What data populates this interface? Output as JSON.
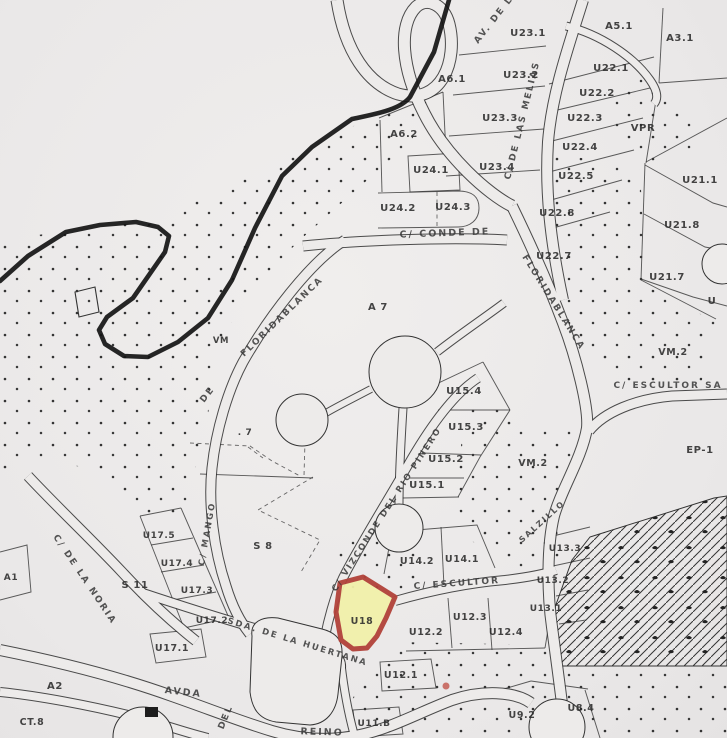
{
  "map": {
    "type": "scanned cadastral parcel plan",
    "background_color": "#edebea",
    "line_color": "#2e2e2e",
    "highlight_parcel": {
      "label": "U18",
      "fill": "#f2f1aa",
      "stroke": "#b2423a",
      "path": "M340,583 L363,577 L395,597 L386,618 L377,636 L367,648 L353,649 L341,640 L336,612 Z",
      "label_x": 362,
      "label_y": 624
    },
    "parcel_labels": [
      {
        "t": "U23.1",
        "x": 528,
        "y": 36
      },
      {
        "t": "A5.1",
        "x": 619,
        "y": 29
      },
      {
        "t": "A3.1",
        "x": 680,
        "y": 41
      },
      {
        "t": "A6.1",
        "x": 452,
        "y": 82
      },
      {
        "t": "U22.1",
        "x": 611,
        "y": 71
      },
      {
        "t": "U23.2",
        "x": 521,
        "y": 78
      },
      {
        "t": "U22.2",
        "x": 597,
        "y": 96
      },
      {
        "t": "U23.3",
        "x": 500,
        "y": 121
      },
      {
        "t": "U22.3",
        "x": 585,
        "y": 121
      },
      {
        "t": "VPR",
        "x": 643,
        "y": 131
      },
      {
        "t": "A6.2",
        "x": 404,
        "y": 137
      },
      {
        "t": "U22.4",
        "x": 580,
        "y": 150
      },
      {
        "t": "U24.1",
        "x": 431,
        "y": 173
      },
      {
        "t": "U23.4",
        "x": 497,
        "y": 170
      },
      {
        "t": "U22.5",
        "x": 576,
        "y": 179
      },
      {
        "t": "U21.1",
        "x": 700,
        "y": 183
      },
      {
        "t": "U24.2",
        "x": 398,
        "y": 211
      },
      {
        "t": "U24.3",
        "x": 453,
        "y": 210
      },
      {
        "t": "U22.8",
        "x": 557,
        "y": 216
      },
      {
        "t": "U21.8",
        "x": 682,
        "y": 228
      },
      {
        "t": "U22.7",
        "x": 554,
        "y": 259
      },
      {
        "t": "U21.7",
        "x": 667,
        "y": 280
      },
      {
        "t": "A 7",
        "x": 378,
        "y": 310
      },
      {
        "t": "U",
        "x": 712,
        "y": 304
      },
      {
        "t": "VM",
        "x": 221,
        "y": 343,
        "s": 8.5
      },
      {
        "t": "VM.2",
        "x": 673,
        "y": 355,
        "s": 9.5
      },
      {
        "t": "U15.4",
        "x": 464,
        "y": 394
      },
      {
        "t": ". 7",
        "x": 245,
        "y": 435,
        "s": 9
      },
      {
        "t": "U15.3",
        "x": 466,
        "y": 430
      },
      {
        "t": "EP-1",
        "x": 700,
        "y": 453
      },
      {
        "t": "U15.2",
        "x": 446,
        "y": 462
      },
      {
        "t": "VM.2",
        "x": 533,
        "y": 466,
        "s": 9.5
      },
      {
        "t": "U15.1",
        "x": 427,
        "y": 488
      },
      {
        "t": "U17.5",
        "x": 159,
        "y": 538,
        "s": 9
      },
      {
        "t": "U13.3",
        "x": 565,
        "y": 551,
        "s": 9
      },
      {
        "t": "S 8",
        "x": 263,
        "y": 549
      },
      {
        "t": "U14.2",
        "x": 417,
        "y": 564,
        "s": 9.5
      },
      {
        "t": "U14.1",
        "x": 462,
        "y": 562,
        "s": 9.5
      },
      {
        "t": "A1",
        "x": 11,
        "y": 580,
        "s": 9
      },
      {
        "t": "S 11",
        "x": 135,
        "y": 588
      },
      {
        "t": "U17.4",
        "x": 177,
        "y": 566,
        "s": 9
      },
      {
        "t": "U13.2",
        "x": 553,
        "y": 583,
        "s": 9
      },
      {
        "t": "U17.3",
        "x": 197,
        "y": 593,
        "s": 9
      },
      {
        "t": "U13.1",
        "x": 546,
        "y": 611,
        "s": 9
      },
      {
        "t": "U12.3",
        "x": 470,
        "y": 620,
        "s": 9.5
      },
      {
        "t": "U12.4",
        "x": 506,
        "y": 635,
        "s": 9.5
      },
      {
        "t": "U12.2",
        "x": 426,
        "y": 635,
        "s": 9.5
      },
      {
        "t": "U17.2",
        "x": 212,
        "y": 623,
        "s": 9
      },
      {
        "t": "U17.1",
        "x": 172,
        "y": 651,
        "s": 9.5
      },
      {
        "t": "A2",
        "x": 55,
        "y": 689
      },
      {
        "t": "U12.1",
        "x": 401,
        "y": 678,
        "s": 9.5
      },
      {
        "t": "CT.8",
        "x": 32,
        "y": 725,
        "s": 9.5
      },
      {
        "t": "U11.B",
        "x": 374,
        "y": 726,
        "s": 9
      },
      {
        "t": "U9.2",
        "x": 522,
        "y": 718,
        "s": 9.5
      },
      {
        "t": "U8.4",
        "x": 581,
        "y": 711,
        "s": 9.5
      }
    ],
    "street_labels": [
      {
        "t": "AV. DE LAS",
        "x": 478,
        "y": 44,
        "r": -52,
        "s": 9
      },
      {
        "t": "C/ DE LAS MELIAS",
        "x": 510,
        "y": 180,
        "r": -76,
        "s": 9
      },
      {
        "t": "C/ CONDE DE",
        "x": 445,
        "y": 236,
        "r": -2,
        "s": 9.5,
        "a": "middle"
      },
      {
        "t": "FLORIDABLANCA",
        "x": 522,
        "y": 257,
        "r": 58,
        "s": 9
      },
      {
        "t": "FLORIDABLANCA",
        "x": 244,
        "y": 357,
        "r": -44,
        "s": 9
      },
      {
        "t": "DE",
        "x": 204,
        "y": 403,
        "r": -52,
        "s": 9
      },
      {
        "t": "C/ VIZCONDE DEL RIO PINERO",
        "x": 336,
        "y": 592,
        "r": -57,
        "s": 8.5
      },
      {
        "t": "C/ MANGO",
        "x": 204,
        "y": 566,
        "r": -80,
        "s": 8.5
      },
      {
        "t": "C/ DE LA NORIA",
        "x": 53,
        "y": 537,
        "r": 56,
        "s": 9
      },
      {
        "t": "SDA. DE LA HUERTANA",
        "x": 227,
        "y": 623,
        "r": 17,
        "s": 8.5
      },
      {
        "t": "C/ ESCULTOR",
        "x": 457,
        "y": 586,
        "r": -4,
        "s": 9,
        "a": "middle"
      },
      {
        "t": "C/ ESCULTOR SA",
        "x": 668,
        "y": 388,
        "r": 0,
        "s": 9,
        "a": "middle"
      },
      {
        "t": "SALZILLO",
        "x": 522,
        "y": 543,
        "r": -42,
        "s": 8
      },
      {
        "t": "AVDA",
        "x": 183,
        "y": 695,
        "r": 6,
        "s": 9.5,
        "a": "middle"
      },
      {
        "t": "DEL",
        "x": 228,
        "y": 718,
        "r": -68,
        "s": 9,
        "a": "middle"
      },
      {
        "t": "REINO",
        "x": 322,
        "y": 735,
        "r": 2,
        "s": 9.5,
        "a": "middle"
      }
    ],
    "roads": [
      {
        "n": "av-melias-loop",
        "d": "M337,0 C345,52 368,84 398,94 C442,106 458,60 449,24 C444,4 427,-3 416,7 C398,25 401,68 424,113 C446,157 488,194 512,206",
        "w": 11
      },
      {
        "n": "floridablanca-north",
        "d": "M583,0 C570,42 552,92 548,142 C545,190 550,240 563,300",
        "w": 10
      },
      {
        "n": "floridablanca",
        "d": "M512,206 C530,243 548,283 563,323 C576,357 589,408 587,428 C582,458 561,490 554,516 C547,545 547,592 552,627 C556,658 562,700 566,738",
        "w": 10
      },
      {
        "n": "road-topright",
        "d": "M566,26 C600,34 634,57 650,80 C657,90 659,98 654,104",
        "w": 7
      },
      {
        "n": "conde-de",
        "d": "M303,246 C360,240 450,237 507,240",
        "w": 9
      },
      {
        "n": "de-floridablanca-mango",
        "d": "M345,240 C310,262 268,318 243,362 C228,390 216,430 212,468 C208,505 214,550 226,586 C233,609 241,623 250,634",
        "w": 9
      },
      {
        "n": "vizconde-del-rio",
        "d": "M478,378 C452,395 428,430 408,465 C388,500 358,548 343,578 C335,595 327,622 323,648",
        "w": 8
      },
      {
        "n": "escultor-bottom",
        "d": "M395,601 C430,591 470,583 505,580 C530,577 545,574 556,570",
        "w": 8
      },
      {
        "n": "escultor-right",
        "d": "M589,431 C604,412 636,399 672,396 L727,394",
        "w": 9
      },
      {
        "n": "huertana",
        "d": "M140,592 C200,612 258,630 316,645 C334,650 342,658 341,668",
        "w": 8
      },
      {
        "n": "avda-del-reino",
        "d": "M0,650 C60,662 122,678 172,696 C212,710 242,722 272,731 C302,740 332,741 360,735 C392,728 420,712 452,700 C482,690 514,691 531,703",
        "w": 10
      },
      {
        "n": "ct8-road",
        "d": "M0,692 C40,696 92,706 132,716 C162,724 190,734 208,738",
        "w": 8
      },
      {
        "n": "noria",
        "d": "M28,476 C55,505 92,540 122,572 C146,598 172,622 196,641",
        "w": 9
      },
      {
        "n": "circle-connector-ne",
        "d": "M437,352 C460,334 484,318 504,303",
        "w": 7
      },
      {
        "n": "circle-connector-w",
        "d": "M371,389 C352,399 336,407 326,413",
        "w": 6
      },
      {
        "n": "circle-connector-s",
        "d": "M403,408 C401,440 399,472 399,505",
        "w": 7
      },
      {
        "n": "blob-east-street",
        "d": "M341,664 C344,690 348,712 354,734",
        "w": 7
      }
    ],
    "thick_boundary": "M449,0 L434,52 L410,97 C400,110 375,114 352,119 L312,147 L282,176 L255,228 L232,280 L208,318 L178,342 L148,357 L124,356 L105,344 L99,330 L107,317 L133,298 L165,252 L169,236 L158,227 L136,222 L100,225 L66,232 L28,256 L0,281",
    "thin_lines": [
      "M379,118 L443,92",
      "M380,120 L382,192",
      "M443,92 L446,154",
      "M408,156 L458,153 L460,190 L410,192 Z",
      "M378,193 L458,191 C476,191 479,200 479,208 C479,220 470,227 458,227 L378,228",
      "M459,55 L546,46",
      "M453,95 L545,86",
      "M449,136 L544,129",
      "M446,176 L540,170",
      "M549,84 L654,57",
      "M549,112 L650,88",
      "M548,142 L643,118",
      "M549,172 L634,150",
      "M551,200 L622,180",
      "M553,228 L610,212",
      "M663,8 L659,83",
      "M659,83 L727,78",
      "M646,162 L727,118",
      "M645,165 L713,203 L727,207",
      "M644,214 L705,247 L727,251",
      "M641,279 L693,297 L727,306",
      "M645,163 L641,280",
      "M641,280 L716,319",
      "M656,100 L646,163",
      "M430,387 L483,362",
      "M483,362 L510,410",
      "M438,410 L510,410",
      "M422,453 L481,455",
      "M410,478 L464,478",
      "M402,498 L459,497",
      "M510,410 L480,457 L458,497",
      "M392,532 L477,525 L495,568",
      "M392,532 L384,574",
      "M441,527 L444,586",
      "M553,536 L590,527",
      "M553,566 L590,558",
      "M556,596 L588,590",
      "M559,624 L586,620",
      "M448,598 L452,648",
      "M488,598 L492,650",
      "M406,651 L545,648",
      "M545,648 L549,624",
      "M380,662 L431,659 L436,688 L382,691 Z",
      "M353,710 L399,707 L403,734 L356,737 Z",
      "M466,700 L531,681",
      "M531,681 L588,689",
      "M585,690 L600,738",
      "M140,516 L184,628",
      "M181,508 L229,618",
      "M140,516 L181,508",
      "M151,545 L193,538",
      "M161,572 L204,565",
      "M173,600 L216,592",
      "M184,628 L229,618",
      "M150,634 L201,629 L206,657 L156,663 Z",
      "M0,552 L27,545 L31,592 L0,600",
      "M200,474 L313,478"
    ],
    "dashed_lines": [
      "M437,192 L437,227",
      "M190,443 L250,446 L272,461 L300,476",
      "M305,441 L304,476",
      "M313,477 L258,510 L320,540 L301,572",
      "M248,447 L263,458"
    ],
    "circles": [
      {
        "cx": 405,
        "cy": 372,
        "r": 36
      },
      {
        "cx": 302,
        "cy": 420,
        "r": 26
      },
      {
        "cx": 399,
        "cy": 528,
        "r": 24
      },
      {
        "cx": 143,
        "cy": 737,
        "r": 30
      },
      {
        "cx": 557,
        "cy": 727,
        "r": 28
      },
      {
        "cx": 722,
        "cy": 264,
        "r": 20
      }
    ],
    "blobs": [
      "M252,636 C250,622 262,616 278,618 L322,629 C338,633 343,642 342,656 L338,694 C336,712 326,724 310,725 L276,722 C258,719 252,708 250,692 Z"
    ],
    "dot_regions": [
      "0,240 150,220 300,152 432,88 412,140 345,200 300,240 240,300 218,360 205,430 195,470 188,515 150,520 100,470 40,460 0,478",
      "606,86 650,76 692,108 700,145 650,162 608,135",
      "552,152 640,170 646,286 716,322 700,388 618,384 560,332 546,238",
      "472,398 540,430 580,432 556,515 560,566 520,570 470,540 455,498 462,438",
      "333,576 346,528 395,545 428,558 405,592 362,594",
      "396,642 545,645 558,668 727,668 727,738 352,738 352,700 370,664"
    ],
    "hatch_region": "590,537 714,498 727,496 727,666 560,666 549,624 572,560",
    "markers": {
      "red_dot": {
        "cx": 446,
        "cy": 686,
        "r": 3.5,
        "color": "#c2544a"
      },
      "black_square": {
        "x": 145,
        "y": 707,
        "w": 13,
        "h": 10,
        "color": "#1d1d1d"
      },
      "plot_symbol": {
        "points": "75,292 95,287 99,312 79,317"
      }
    }
  }
}
